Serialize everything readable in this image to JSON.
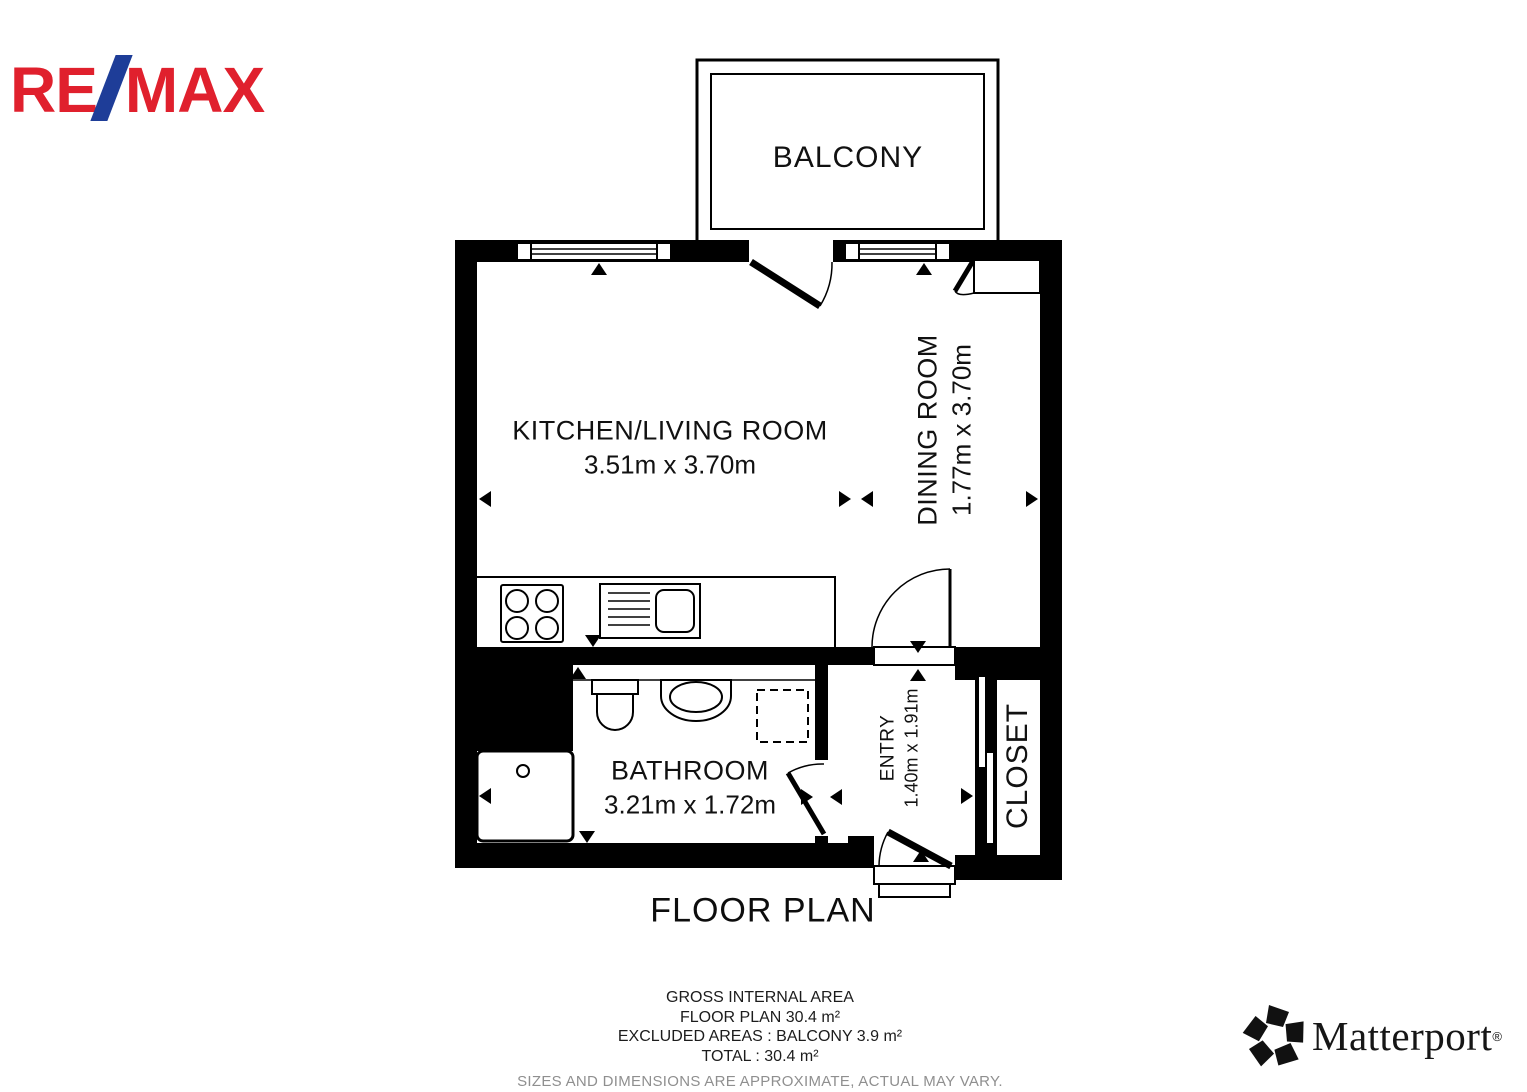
{
  "logos": {
    "remax": {
      "re": "RE",
      "max": "MAX",
      "red": "#E0202D",
      "blue": "#1E3D98"
    },
    "matterport": {
      "name": "Matterport",
      "registered": "®"
    }
  },
  "plan": {
    "rooms": {
      "balcony": {
        "name": "BALCONY"
      },
      "kitchen_living": {
        "name": "KITCHEN/LIVING ROOM",
        "dims": "3.51m x 3.70m"
      },
      "dining": {
        "name": "DINING ROOM",
        "dims": "1.77m x 3.70m"
      },
      "bathroom": {
        "name": "BATHROOM",
        "dims": "3.21m x 1.72m"
      },
      "entry": {
        "name": "ENTRY",
        "dims": "1.40m x 1.91m"
      },
      "closet": {
        "name": "CLOSET"
      }
    },
    "wall_color": "#000000",
    "floor_color": "#ffffff"
  },
  "caption": {
    "title": "FLOOR PLAN"
  },
  "summary": {
    "heading": "GROSS INTERNAL AREA",
    "floor_plan": "FLOOR PLAN 30.4 m²",
    "excluded": "EXCLUDED AREAS :  BALCONY 3.9 m²",
    "total": "TOTAL :  30.4 m²",
    "disclaimer": "SIZES AND DIMENSIONS ARE APPROXIMATE, ACTUAL MAY VARY."
  }
}
